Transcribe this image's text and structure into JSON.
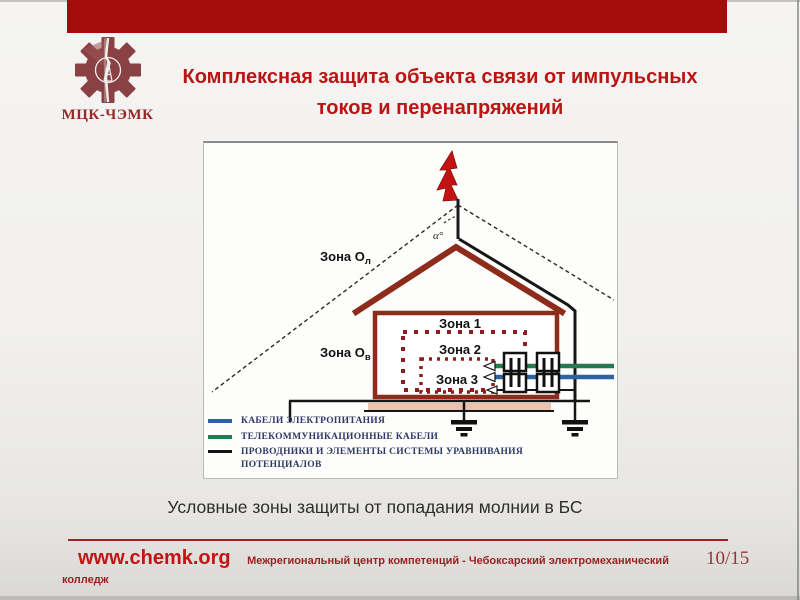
{
  "header": {
    "logo_text": "МЦК-ЧЭМК",
    "title_line1": "Комплексная защита объекта связи от импульсных",
    "title_line2": "токов и перенапряжений"
  },
  "diagram": {
    "zone_ol": {
      "main": "Зона О",
      "sub": "л"
    },
    "zone_ov": {
      "main": "Зона О",
      "sub": "в"
    },
    "zone1": "Зона 1",
    "zone2": "Зона 2",
    "zone3": "Зона 3",
    "alpha": "α°",
    "legend": {
      "items": [
        {
          "label": "КАБЕЛИ ЭЛЕКТРОПИТАНИЯ",
          "color": "#2e62a1"
        },
        {
          "label": "ТЕЛЕКОММУНИКАЦИОННЫЕ КАБЕЛИ",
          "color": "#27794f"
        },
        {
          "label": "ПРОВОДНИКИ И ЭЛЕМЕНТЫ СИСТЕМЫ УРАВНИВАНИЯ ПОТЕНЦИАЛОВ",
          "color": "#141414"
        }
      ]
    }
  },
  "caption": "Условные зоны защиты от попадания молнии в БС",
  "footer": {
    "url": "www.chemk.org",
    "org": "Межрегиональный центр компетенций - Чебоксарский электромеханический колледж",
    "page": "10/15"
  },
  "colors": {
    "top_bar": "#a40c0c",
    "title_text": "#bb1414",
    "house_outline": "#8e2c1c",
    "zone_dotted": "#8e1d1d",
    "lightning_bolt": "#c41212",
    "power_cable": "#2e62a1",
    "telecom_cable": "#27794f",
    "footer_accent": "#a32020"
  }
}
